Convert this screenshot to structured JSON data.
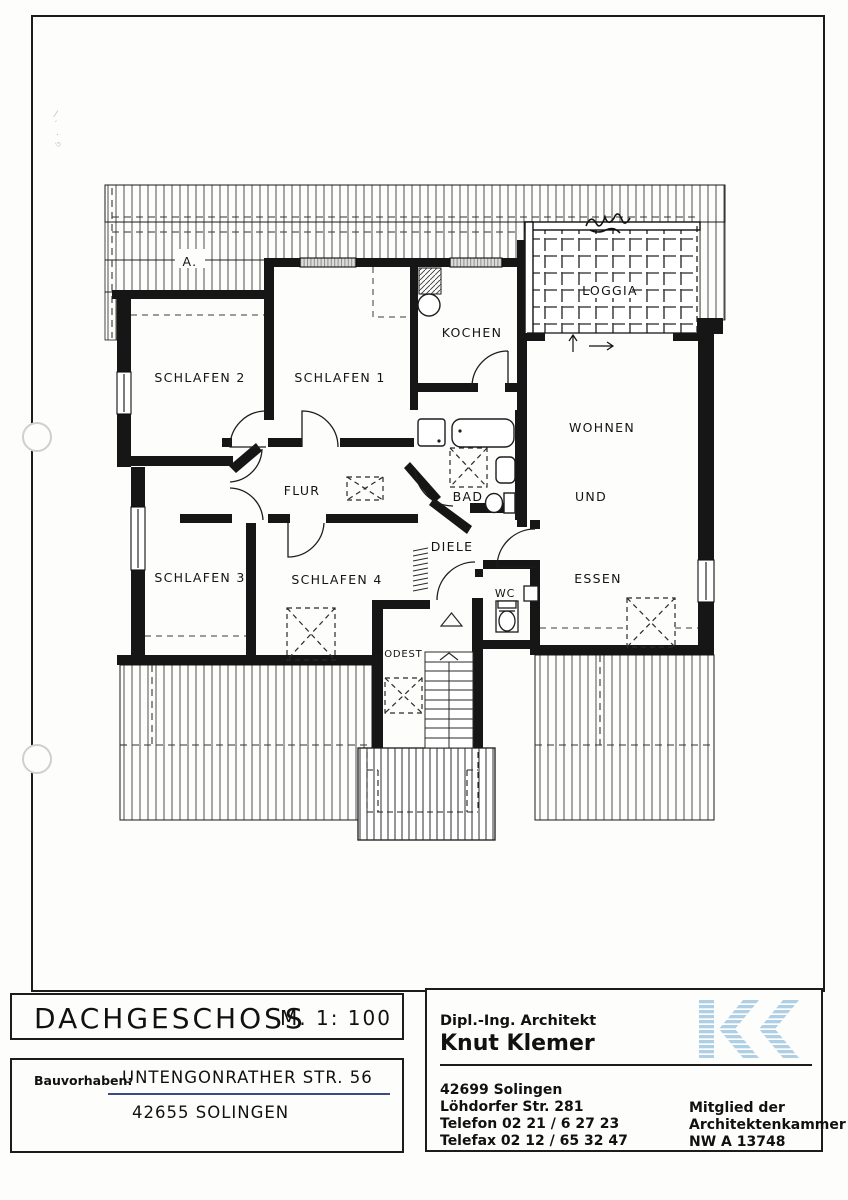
{
  "plan": {
    "labels": {
      "attic_mark": "A.",
      "schlafen2": "SCHLAFEN 2",
      "schlafen1": "SCHLAFEN 1",
      "kochen": "KOCHEN",
      "loggia": "LOGGIA",
      "wohnen": "WOHNEN",
      "und": "UND",
      "essen": "ESSEN",
      "flur": "FLUR",
      "bad": "BAD",
      "diele": "DIELE",
      "schlafen3": "SCHLAFEN 3",
      "schlafen4": "SCHLAFEN 4",
      "wc": "WC",
      "podest": "PODEST"
    }
  },
  "title_block": {
    "drawing_title": "DACHGESCHOSS",
    "scale": "M. 1: 100",
    "project_label": "Bauvorhaben:",
    "project_street": "UNTENGONRATHER STR. 56",
    "project_city": "42655 SOLINGEN",
    "architect_role": "Dipl.-Ing. Architekt",
    "architect_name": "Knut Klemer",
    "address_lines": [
      "42699 Solingen",
      "Löhdorfer Str. 281",
      "Telefon 02 21 / 6 27 23",
      "Telefax 02 12 / 65 32 47"
    ],
    "membership_lines": [
      "Mitglied der",
      "Architektenkammer",
      "NW A 13748"
    ],
    "colors": {
      "logo_blue": "#aecfe4",
      "ink_blue": "#3e4b80"
    }
  }
}
